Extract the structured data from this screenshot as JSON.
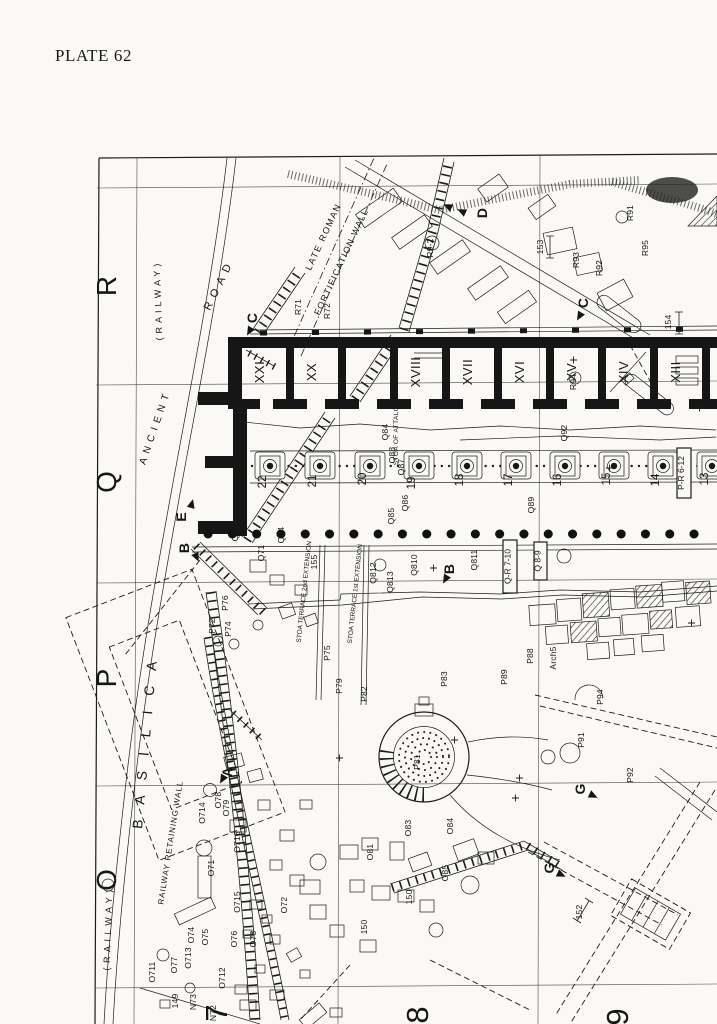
{
  "colors": {
    "paper": "#faf9f5",
    "ink": "#1c1c1c"
  },
  "page": {
    "plate_label": "PLATE 62"
  },
  "grid": {
    "row_letters": [
      "R",
      "Q",
      "P",
      "O"
    ],
    "col_numbers": [
      "7",
      "8",
      "9"
    ]
  },
  "areas": {
    "railway_top": "(RAILWAY)",
    "railway_bottom": "(RAILWAY)",
    "ancient": "ANCIENT",
    "road": "ROAD",
    "late_roman_line1": "LATE ROMAN",
    "late_roman_line2": "FORTIFICATION WALL",
    "railway_retaining_wall": "RAILWAY RETAINING WALL",
    "basilica": "BASILICA",
    "stoa_note_line1": "STOA OF ATTALOS:",
    "stoa_note_line2": "ORIGINAL N END",
    "terrace_second": "STOA TERRACE 2nd EXTENSION",
    "terrace_first": "STOA TERRACE 1st EXTENSION"
  },
  "stoa": {
    "rooms": [
      "XXI",
      "XX",
      "XVIII",
      "XVII",
      "XVI",
      "XV",
      "XIV",
      "XIII"
    ],
    "columns": [
      "22",
      "21",
      "20",
      "19",
      "18",
      "17",
      "16",
      "15",
      "14",
      "13"
    ]
  },
  "boxed": [
    "Q-R 7-10",
    "Q 8-9",
    "P-R 6-12"
  ],
  "sections": [
    "C",
    "D",
    "C",
    "E",
    "B",
    "B",
    "A",
    "G",
    "G"
  ],
  "finds": [
    "R71",
    "R72",
    "R9-2",
    "R93",
    "R92",
    "R91",
    "R95",
    "153",
    "154",
    "R94",
    "Q92",
    "Q84",
    "Q88",
    "Q87",
    "Q86",
    "Q85",
    "Q89",
    "Q811",
    "Q72",
    "Q71",
    "Q74",
    "155",
    "Q812",
    "Q813",
    "Q810",
    "P76",
    "P72",
    "P74",
    "P75",
    "P79",
    "P82",
    "P83",
    "P88",
    "P89",
    "Arch5",
    "P81",
    "P91",
    "P94",
    "P92",
    "O78",
    "O79",
    "O714",
    "O716",
    "O71",
    "O715",
    "O72",
    "O711",
    "O77",
    "O713",
    "O74",
    "O75",
    "O76",
    "O73",
    "O712",
    "149",
    "N73",
    "N72",
    "O81",
    "O83",
    "O84",
    "O85",
    "150",
    "150",
    "152"
  ]
}
